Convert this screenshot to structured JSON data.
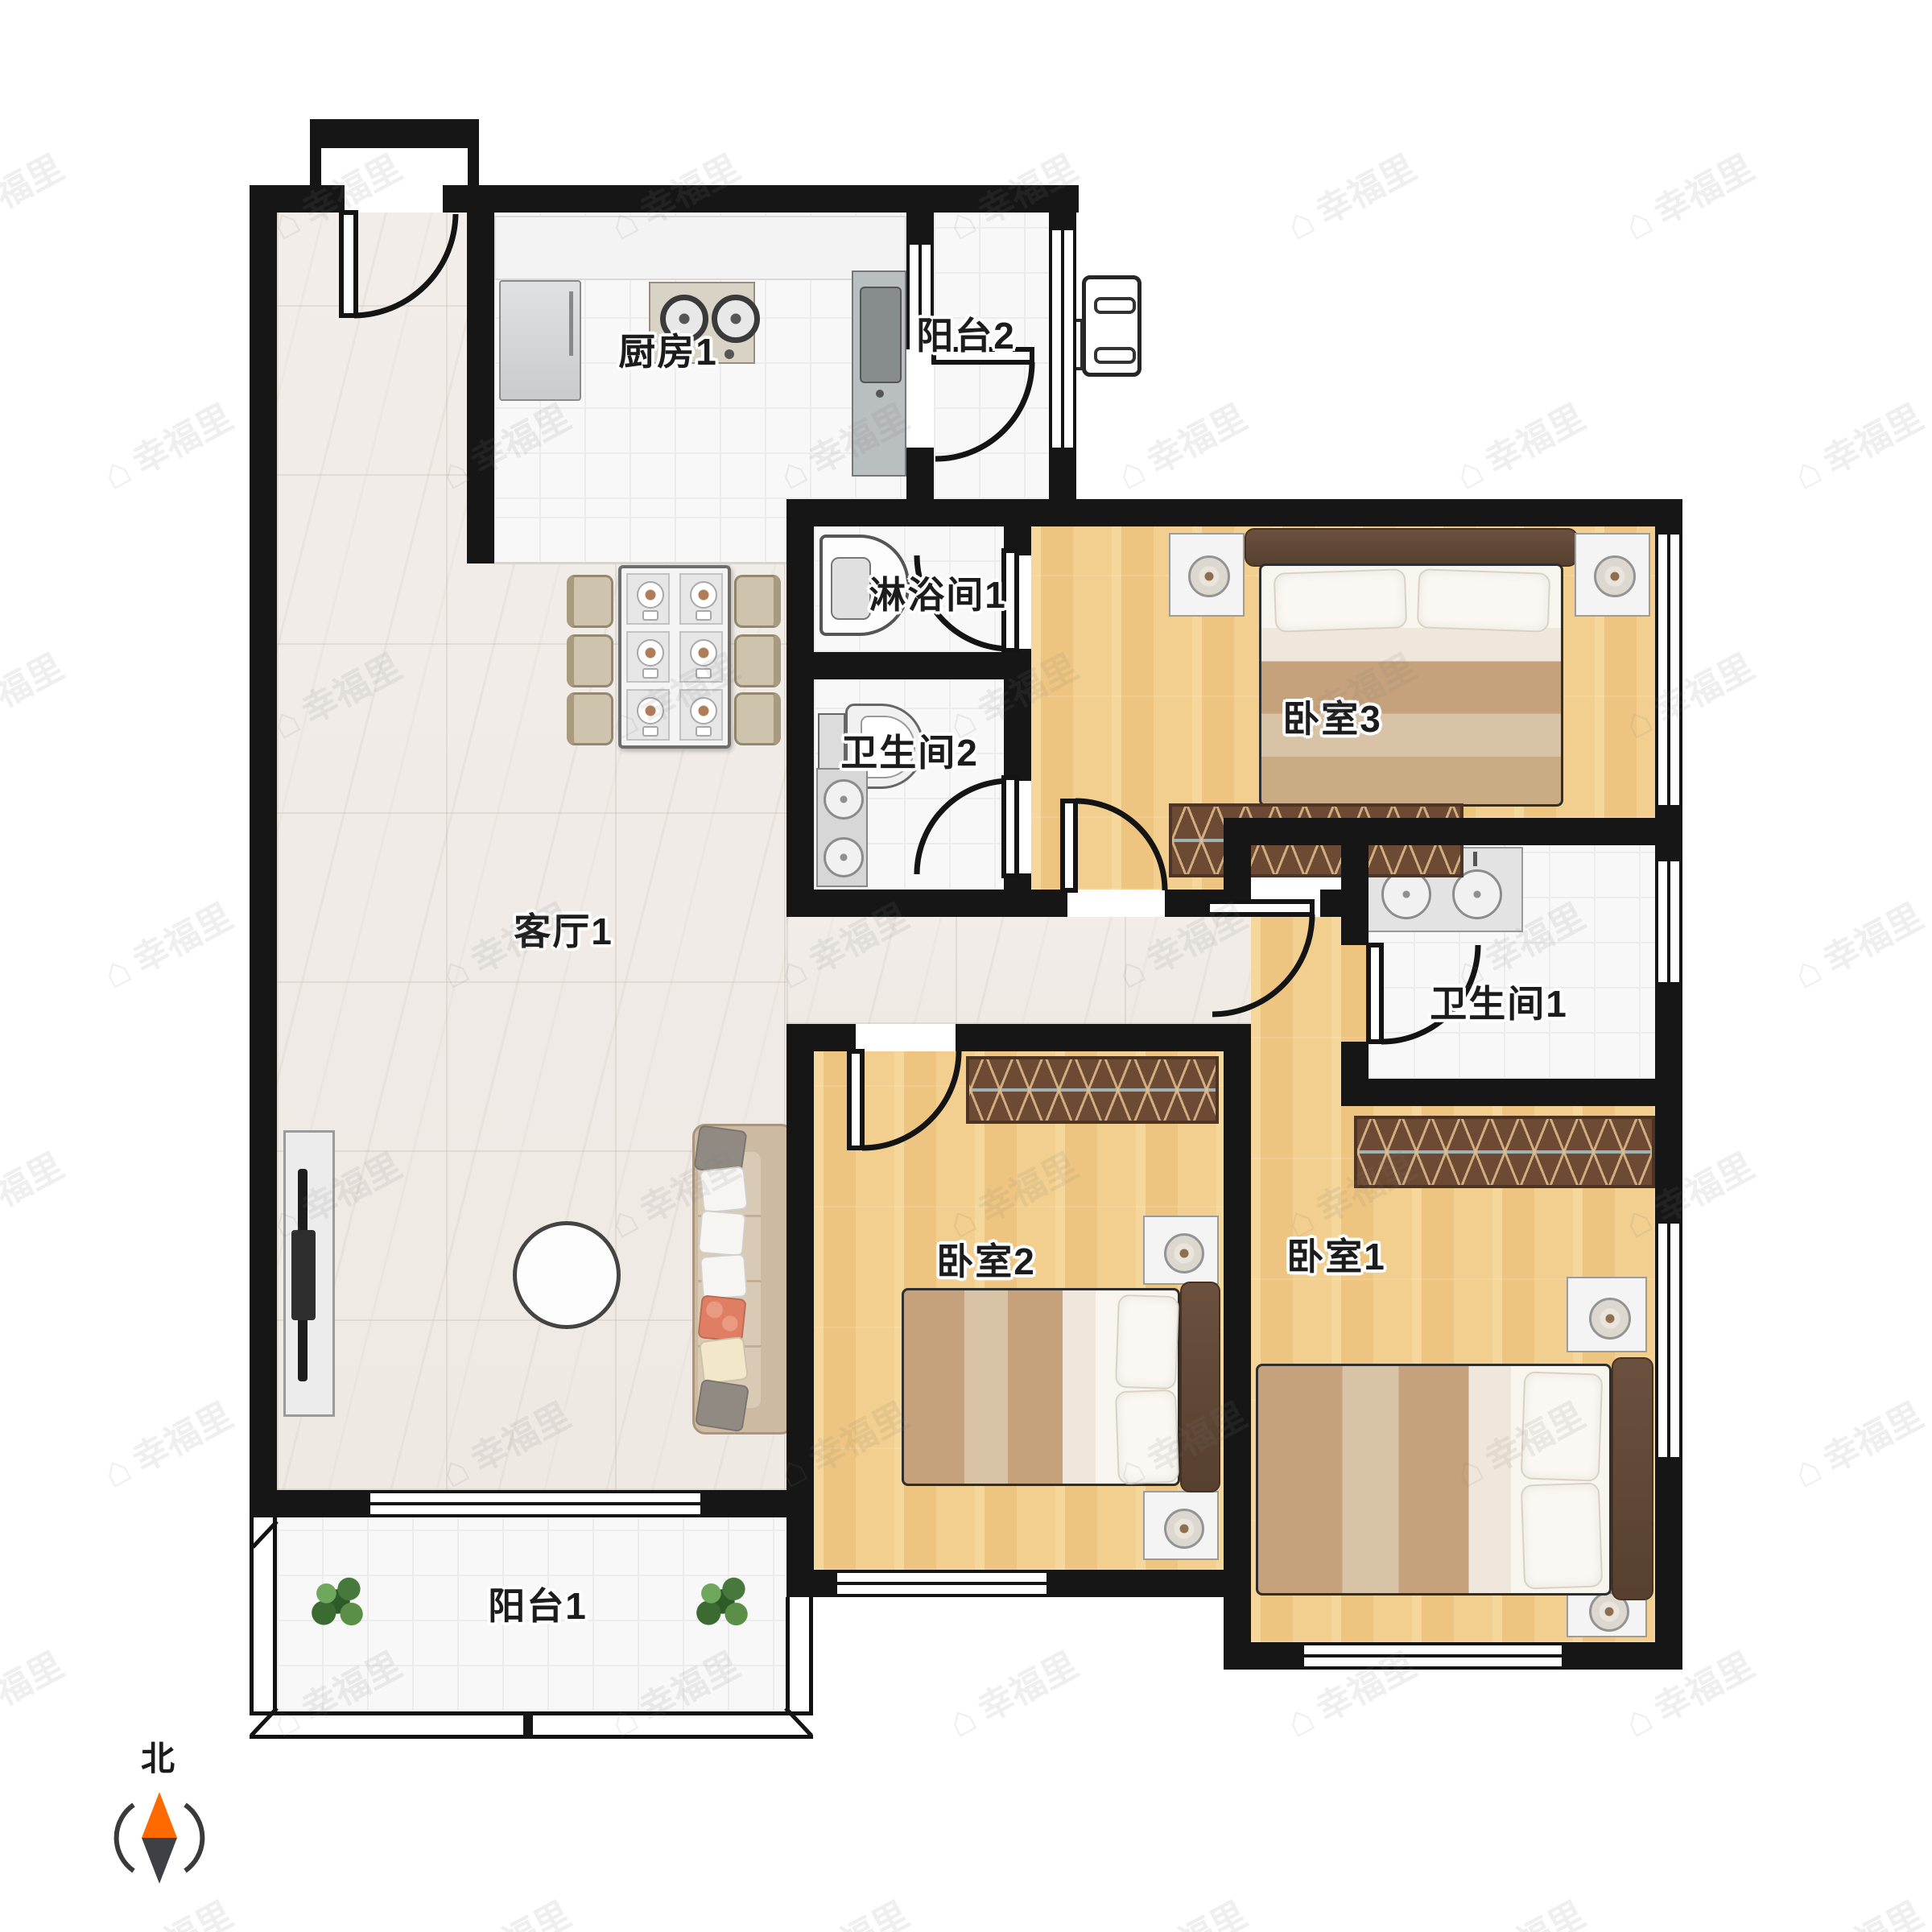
{
  "rooms": [
    {
      "id": "kitchen",
      "label": "厨房1"
    },
    {
      "id": "balcony2",
      "label": "阳台2"
    },
    {
      "id": "shower1",
      "label": "淋浴间1"
    },
    {
      "id": "bath2",
      "label": "卫生间2"
    },
    {
      "id": "bedroom3",
      "label": "卧室3"
    },
    {
      "id": "living",
      "label": "客厅1"
    },
    {
      "id": "bath1",
      "label": "卫生间1"
    },
    {
      "id": "bedroom2",
      "label": "卧室2"
    },
    {
      "id": "bedroom1",
      "label": "卧室1"
    },
    {
      "id": "balcony1",
      "label": "阳台1"
    }
  ],
  "compass": {
    "label": "北",
    "needle_north_color": "#ff6a00",
    "needle_south_color": "#3f3f46"
  },
  "watermark": {
    "text": "幸福里"
  },
  "colors": {
    "wall": "#161616",
    "wood_floor": "#f2cf8e",
    "marble_floor": "#efe9e4",
    "white_tile": "#f8f8f8",
    "furniture_brown": "#6d4a33"
  }
}
